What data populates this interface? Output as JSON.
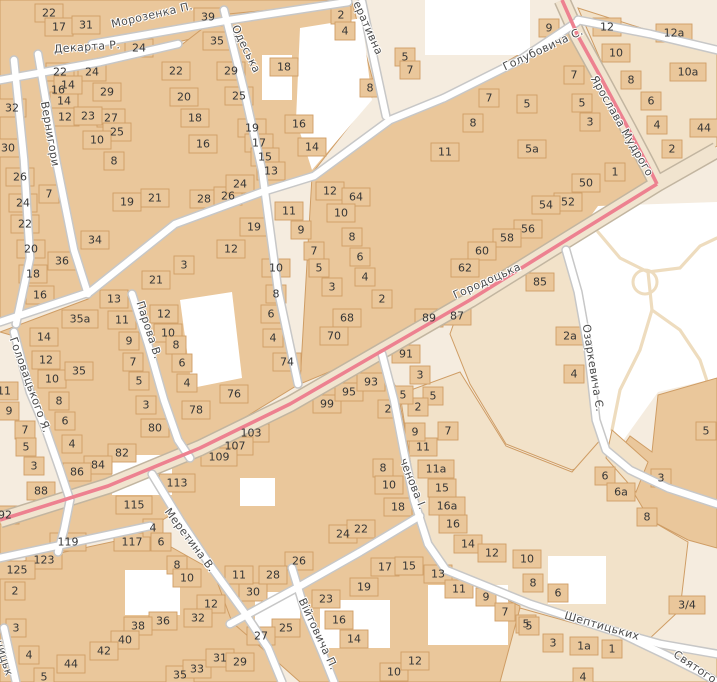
{
  "map": {
    "colors": {
      "background": "#f5ecdf",
      "building_fill": "#eac79b",
      "building_stroke": "#cf9d65",
      "parcel_fill": "#f2e2c9",
      "street_fill": "#ffffff",
      "street_casing": "#c7c7c7",
      "road_fill": "#f1e4cf",
      "road_casing": "#c2b5a0",
      "tram_line": "#ed8190",
      "park_fill": "#ffffff",
      "park_path": "#eedcbe",
      "street_label_color": "#4b4b4b",
      "house_number_color": "#363636"
    },
    "street_labels": [
      {
        "name": "Морозенка П.",
        "x": 152,
        "y": 15,
        "angle": -13
      },
      {
        "name": "Декарта Р.",
        "x": 87,
        "y": 47,
        "angle": -4
      },
      {
        "name": "Одеська",
        "x": 246,
        "y": 49,
        "angle": 64
      },
      {
        "name": "еративна",
        "x": 368,
        "y": 28,
        "angle": 66
      },
      {
        "name": "Голубовича С.",
        "x": 543,
        "y": 49,
        "angle": -25
      },
      {
        "name": "Ярослава Мудрого",
        "x": 622,
        "y": 126,
        "angle": 60
      },
      {
        "name": "Городоцька",
        "x": 487,
        "y": 281,
        "angle": -24
      },
      {
        "name": "Вернигори",
        "x": 50,
        "y": 134,
        "angle": 80
      },
      {
        "name": "Парова В.",
        "x": 149,
        "y": 330,
        "angle": 72
      },
      {
        "name": "Головацького Я.",
        "x": 30,
        "y": 385,
        "angle": 70
      },
      {
        "name": "Озаркевича Є.",
        "x": 593,
        "y": 368,
        "angle": 81
      },
      {
        "name": "ченова І.",
        "x": 413,
        "y": 484,
        "angle": 68
      },
      {
        "name": "Меретина В.",
        "x": 190,
        "y": 540,
        "angle": 53
      },
      {
        "name": "Війтовича П.",
        "x": 318,
        "y": 634,
        "angle": 65
      },
      {
        "name": "Шептицьких",
        "x": 602,
        "y": 626,
        "angle": 16
      },
      {
        "name": "Святого",
        "x": 695,
        "y": 667,
        "angle": 34
      },
      {
        "name": "ницьк",
        "x": 4,
        "y": 658,
        "angle": 73
      }
    ],
    "house_numbers": [
      {
        "n": "22",
        "x": 49,
        "y": 13
      },
      {
        "n": "17",
        "x": 59,
        "y": 27
      },
      {
        "n": "31",
        "x": 86,
        "y": 25
      },
      {
        "n": "24",
        "x": 139,
        "y": 48
      },
      {
        "n": "39",
        "x": 208,
        "y": 17
      },
      {
        "n": "35",
        "x": 217,
        "y": 41
      },
      {
        "n": "22",
        "x": 60,
        "y": 72
      },
      {
        "n": "24",
        "x": 92,
        "y": 72
      },
      {
        "n": "22",
        "x": 176,
        "y": 71
      },
      {
        "n": "29",
        "x": 231,
        "y": 71
      },
      {
        "n": "16",
        "x": 58,
        "y": 90
      },
      {
        "n": "14",
        "x": 64,
        "y": 101
      },
      {
        "n": "12",
        "x": 65,
        "y": 117
      },
      {
        "n": "14",
        "x": 68,
        "y": 85
      },
      {
        "n": "32",
        "x": 12,
        "y": 108
      },
      {
        "n": "30",
        "x": 8,
        "y": 148
      },
      {
        "n": "26",
        "x": 20,
        "y": 177
      },
      {
        "n": "24",
        "x": 23,
        "y": 203
      },
      {
        "n": "22",
        "x": 25,
        "y": 224
      },
      {
        "n": "29",
        "x": 107,
        "y": 92
      },
      {
        "n": "27",
        "x": 111,
        "y": 118
      },
      {
        "n": "25",
        "x": 117,
        "y": 132
      },
      {
        "n": "23",
        "x": 88,
        "y": 116
      },
      {
        "n": "10",
        "x": 97,
        "y": 140
      },
      {
        "n": "8",
        "x": 114,
        "y": 161
      },
      {
        "n": "20",
        "x": 184,
        "y": 97
      },
      {
        "n": "18",
        "x": 195,
        "y": 118
      },
      {
        "n": "16",
        "x": 203,
        "y": 144
      },
      {
        "n": "25",
        "x": 239,
        "y": 96
      },
      {
        "n": "19",
        "x": 252,
        "y": 128
      },
      {
        "n": "17",
        "x": 259,
        "y": 143
      },
      {
        "n": "15",
        "x": 265,
        "y": 157
      },
      {
        "n": "13",
        "x": 271,
        "y": 171
      },
      {
        "n": "18",
        "x": 284,
        "y": 67
      },
      {
        "n": "16",
        "x": 299,
        "y": 124
      },
      {
        "n": "14",
        "x": 312,
        "y": 147
      },
      {
        "n": "2",
        "x": 341,
        "y": 15
      },
      {
        "n": "4",
        "x": 345,
        "y": 31
      },
      {
        "n": "8",
        "x": 370,
        "y": 88
      },
      {
        "n": "5",
        "x": 405,
        "y": 57
      },
      {
        "n": "7",
        "x": 410,
        "y": 70
      },
      {
        "n": "9",
        "x": 549,
        "y": 28
      },
      {
        "n": "7",
        "x": 49,
        "y": 194
      },
      {
        "n": "19",
        "x": 127,
        "y": 202
      },
      {
        "n": "21",
        "x": 155,
        "y": 198
      },
      {
        "n": "28",
        "x": 204,
        "y": 199
      },
      {
        "n": "26",
        "x": 228,
        "y": 196
      },
      {
        "n": "24",
        "x": 240,
        "y": 184
      },
      {
        "n": "34",
        "x": 95,
        "y": 240
      },
      {
        "n": "20",
        "x": 31,
        "y": 249
      },
      {
        "n": "36",
        "x": 62,
        "y": 261
      },
      {
        "n": "18",
        "x": 33,
        "y": 274
      },
      {
        "n": "16",
        "x": 40,
        "y": 295
      },
      {
        "n": "3",
        "x": 184,
        "y": 265
      },
      {
        "n": "21",
        "x": 156,
        "y": 280
      },
      {
        "n": "13",
        "x": 114,
        "y": 299
      },
      {
        "n": "35a",
        "x": 80,
        "y": 319
      },
      {
        "n": "11",
        "x": 122,
        "y": 320
      },
      {
        "n": "12",
        "x": 164,
        "y": 314
      },
      {
        "n": "10",
        "x": 168,
        "y": 333
      },
      {
        "n": "8",
        "x": 176,
        "y": 345
      },
      {
        "n": "6",
        "x": 182,
        "y": 363
      },
      {
        "n": "4",
        "x": 187,
        "y": 383
      },
      {
        "n": "78",
        "x": 196,
        "y": 410
      },
      {
        "n": "14",
        "x": 44,
        "y": 337
      },
      {
        "n": "12",
        "x": 46,
        "y": 360
      },
      {
        "n": "10",
        "x": 52,
        "y": 379
      },
      {
        "n": "35",
        "x": 79,
        "y": 371
      },
      {
        "n": "8",
        "x": 59,
        "y": 401
      },
      {
        "n": "6",
        "x": 65,
        "y": 421
      },
      {
        "n": "4",
        "x": 72,
        "y": 444
      },
      {
        "n": "9",
        "x": 129,
        "y": 341
      },
      {
        "n": "7",
        "x": 133,
        "y": 362
      },
      {
        "n": "5",
        "x": 139,
        "y": 381
      },
      {
        "n": "3",
        "x": 146,
        "y": 405
      },
      {
        "n": "80",
        "x": 155,
        "y": 428
      },
      {
        "n": "82",
        "x": 122,
        "y": 453
      },
      {
        "n": "84",
        "x": 98,
        "y": 465
      },
      {
        "n": "86",
        "x": 77,
        "y": 472
      },
      {
        "n": "88",
        "x": 41,
        "y": 491
      },
      {
        "n": "11",
        "x": 4,
        "y": 391
      },
      {
        "n": "9",
        "x": 9,
        "y": 411
      },
      {
        "n": "7",
        "x": 25,
        "y": 430
      },
      {
        "n": "5",
        "x": 26,
        "y": 447
      },
      {
        "n": "3",
        "x": 34,
        "y": 466
      },
      {
        "n": "92",
        "x": 5,
        "y": 515
      },
      {
        "n": "113",
        "x": 177,
        "y": 483
      },
      {
        "n": "115",
        "x": 134,
        "y": 505
      },
      {
        "n": "119",
        "x": 68,
        "y": 542
      },
      {
        "n": "117",
        "x": 132,
        "y": 542
      },
      {
        "n": "123",
        "x": 44,
        "y": 560
      },
      {
        "n": "125",
        "x": 17,
        "y": 570
      },
      {
        "n": "4",
        "x": 153,
        "y": 528
      },
      {
        "n": "6",
        "x": 161,
        "y": 542
      },
      {
        "n": "8",
        "x": 177,
        "y": 565
      },
      {
        "n": "10",
        "x": 187,
        "y": 578
      },
      {
        "n": "12",
        "x": 211,
        "y": 604
      },
      {
        "n": "2",
        "x": 15,
        "y": 591
      },
      {
        "n": "3",
        "x": 16,
        "y": 628
      },
      {
        "n": "4",
        "x": 29,
        "y": 655
      },
      {
        "n": "5",
        "x": 44,
        "y": 677
      },
      {
        "n": "36",
        "x": 163,
        "y": 621
      },
      {
        "n": "32",
        "x": 198,
        "y": 618
      },
      {
        "n": "38",
        "x": 138,
        "y": 626
      },
      {
        "n": "40",
        "x": 125,
        "y": 640
      },
      {
        "n": "42",
        "x": 104,
        "y": 651
      },
      {
        "n": "44",
        "x": 71,
        "y": 664
      },
      {
        "n": "35",
        "x": 180,
        "y": 675
      },
      {
        "n": "33",
        "x": 197,
        "y": 669
      },
      {
        "n": "31",
        "x": 220,
        "y": 658
      },
      {
        "n": "29",
        "x": 240,
        "y": 662
      },
      {
        "n": "30",
        "x": 253,
        "y": 592
      },
      {
        "n": "11",
        "x": 239,
        "y": 575
      },
      {
        "n": "12",
        "x": 330,
        "y": 191
      },
      {
        "n": "64",
        "x": 356,
        "y": 197
      },
      {
        "n": "10",
        "x": 341,
        "y": 213
      },
      {
        "n": "8",
        "x": 352,
        "y": 237
      },
      {
        "n": "6",
        "x": 360,
        "y": 257
      },
      {
        "n": "4",
        "x": 365,
        "y": 277
      },
      {
        "n": "2",
        "x": 382,
        "y": 299
      },
      {
        "n": "19",
        "x": 254,
        "y": 227
      },
      {
        "n": "11",
        "x": 289,
        "y": 211
      },
      {
        "n": "9",
        "x": 301,
        "y": 230
      },
      {
        "n": "12",
        "x": 231,
        "y": 249
      },
      {
        "n": "7",
        "x": 314,
        "y": 251
      },
      {
        "n": "10",
        "x": 276,
        "y": 268
      },
      {
        "n": "5",
        "x": 319,
        "y": 268
      },
      {
        "n": "3",
        "x": 332,
        "y": 287
      },
      {
        "n": "8",
        "x": 276,
        "y": 294
      },
      {
        "n": "6",
        "x": 271,
        "y": 314
      },
      {
        "n": "4",
        "x": 273,
        "y": 338
      },
      {
        "n": "68",
        "x": 347,
        "y": 318
      },
      {
        "n": "70",
        "x": 334,
        "y": 336
      },
      {
        "n": "74",
        "x": 287,
        "y": 362
      },
      {
        "n": "76",
        "x": 234,
        "y": 394
      },
      {
        "n": "99",
        "x": 327,
        "y": 404
      },
      {
        "n": "95",
        "x": 349,
        "y": 392
      },
      {
        "n": "93",
        "x": 371,
        "y": 382
      },
      {
        "n": "103",
        "x": 251,
        "y": 433
      },
      {
        "n": "107",
        "x": 235,
        "y": 446
      },
      {
        "n": "109",
        "x": 219,
        "y": 457
      },
      {
        "n": "2",
        "x": 388,
        "y": 409
      },
      {
        "n": "24",
        "x": 343,
        "y": 534
      },
      {
        "n": "22",
        "x": 361,
        "y": 529
      },
      {
        "n": "18",
        "x": 398,
        "y": 507
      },
      {
        "n": "26",
        "x": 299,
        "y": 561
      },
      {
        "n": "28",
        "x": 273,
        "y": 575
      },
      {
        "n": "25",
        "x": 286,
        "y": 628
      },
      {
        "n": "27",
        "x": 261,
        "y": 636
      },
      {
        "n": "17",
        "x": 385,
        "y": 567
      },
      {
        "n": "15",
        "x": 409,
        "y": 566
      },
      {
        "n": "13",
        "x": 438,
        "y": 574
      },
      {
        "n": "11",
        "x": 459,
        "y": 589
      },
      {
        "n": "9",
        "x": 486,
        "y": 597
      },
      {
        "n": "7",
        "x": 505,
        "y": 612
      },
      {
        "n": "5",
        "x": 526,
        "y": 624
      },
      {
        "n": "19",
        "x": 364,
        "y": 587
      },
      {
        "n": "23",
        "x": 326,
        "y": 599
      },
      {
        "n": "16",
        "x": 339,
        "y": 620
      },
      {
        "n": "14",
        "x": 354,
        "y": 639
      },
      {
        "n": "10",
        "x": 394,
        "y": 672
      },
      {
        "n": "12",
        "x": 415,
        "y": 661
      },
      {
        "n": "16",
        "x": 453,
        "y": 524
      },
      {
        "n": "16a",
        "x": 447,
        "y": 506
      },
      {
        "n": "15",
        "x": 442,
        "y": 488
      },
      {
        "n": "11a",
        "x": 436,
        "y": 469
      },
      {
        "n": "11",
        "x": 423,
        "y": 447
      },
      {
        "n": "9",
        "x": 415,
        "y": 432
      },
      {
        "n": "7",
        "x": 448,
        "y": 431
      },
      {
        "n": "5",
        "x": 433,
        "y": 396
      },
      {
        "n": "2",
        "x": 418,
        "y": 407
      },
      {
        "n": "8",
        "x": 383,
        "y": 468
      },
      {
        "n": "10",
        "x": 389,
        "y": 485
      },
      {
        "n": "91",
        "x": 406,
        "y": 354
      },
      {
        "n": "3",
        "x": 420,
        "y": 375
      },
      {
        "n": "5",
        "x": 403,
        "y": 395
      },
      {
        "n": "89",
        "x": 429,
        "y": 318
      },
      {
        "n": "87",
        "x": 457,
        "y": 316
      },
      {
        "n": "7",
        "x": 489,
        "y": 98
      },
      {
        "n": "8",
        "x": 473,
        "y": 123
      },
      {
        "n": "5",
        "x": 527,
        "y": 104
      },
      {
        "n": "11",
        "x": 445,
        "y": 152
      },
      {
        "n": "5a",
        "x": 532,
        "y": 149
      },
      {
        "n": "7",
        "x": 574,
        "y": 75
      },
      {
        "n": "5",
        "x": 582,
        "y": 103
      },
      {
        "n": "3",
        "x": 590,
        "y": 122
      },
      {
        "n": "12",
        "x": 607,
        "y": 27
      },
      {
        "n": "12a",
        "x": 674,
        "y": 33
      },
      {
        "n": "10",
        "x": 616,
        "y": 53
      },
      {
        "n": "10a",
        "x": 688,
        "y": 72
      },
      {
        "n": "8",
        "x": 631,
        "y": 80
      },
      {
        "n": "6",
        "x": 651,
        "y": 101
      },
      {
        "n": "4",
        "x": 657,
        "y": 125
      },
      {
        "n": "2",
        "x": 672,
        "y": 149
      },
      {
        "n": "44",
        "x": 704,
        "y": 128
      },
      {
        "n": "1",
        "x": 615,
        "y": 172
      },
      {
        "n": "50",
        "x": 586,
        "y": 183
      },
      {
        "n": "52",
        "x": 568,
        "y": 202
      },
      {
        "n": "54",
        "x": 546,
        "y": 205
      },
      {
        "n": "56",
        "x": 528,
        "y": 229
      },
      {
        "n": "58",
        "x": 507,
        "y": 238
      },
      {
        "n": "60",
        "x": 482,
        "y": 251
      },
      {
        "n": "62",
        "x": 465,
        "y": 268
      },
      {
        "n": "85",
        "x": 540,
        "y": 282
      },
      {
        "n": "2a",
        "x": 570,
        "y": 336
      },
      {
        "n": "4",
        "x": 574,
        "y": 374
      },
      {
        "n": "5",
        "x": 706,
        "y": 431
      },
      {
        "n": "6",
        "x": 605,
        "y": 476
      },
      {
        "n": "6a",
        "x": 621,
        "y": 492
      },
      {
        "n": "3",
        "x": 661,
        "y": 478
      },
      {
        "n": "8",
        "x": 647,
        "y": 517
      },
      {
        "n": "14",
        "x": 468,
        "y": 544
      },
      {
        "n": "12",
        "x": 492,
        "y": 553
      },
      {
        "n": "10",
        "x": 527,
        "y": 559
      },
      {
        "n": "8",
        "x": 533,
        "y": 583
      },
      {
        "n": "6",
        "x": 558,
        "y": 593
      },
      {
        "n": "5",
        "x": 529,
        "y": 626
      },
      {
        "n": "3",
        "x": 553,
        "y": 643
      },
      {
        "n": "1a",
        "x": 584,
        "y": 646
      },
      {
        "n": "1",
        "x": 612,
        "y": 649
      },
      {
        "n": "4",
        "x": 583,
        "y": 677
      },
      {
        "n": "3/4",
        "x": 687,
        "y": 605
      }
    ]
  }
}
